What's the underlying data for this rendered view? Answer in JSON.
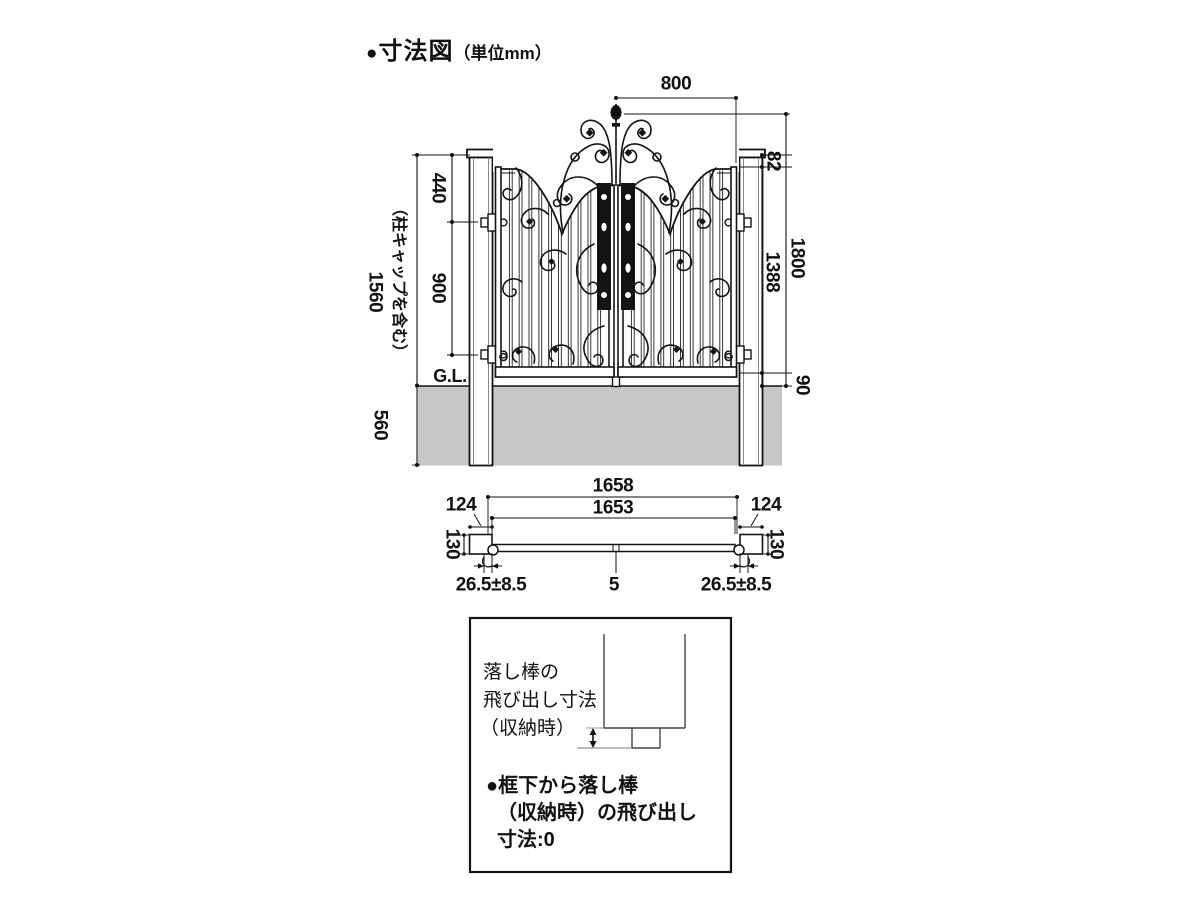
{
  "title": {
    "bullet": "●",
    "main": "寸法図",
    "unit": "（単位mm）"
  },
  "colors": {
    "line": "#1a1a1a",
    "ground_gray": "#c5c7c8",
    "plate_black": "#141414"
  },
  "elevation": {
    "dims": {
      "leaf_width": "800",
      "cap_to_rail": "82",
      "post_top_to_hinge": "440",
      "hinge_span": "900",
      "post_height": "1560",
      "post_height_note": "（柱キャップを含む）",
      "leaf_height": "1388",
      "gate_height": "1800",
      "ground_clearance": "90",
      "embed_depth": "560",
      "ground_line": "G.L."
    }
  },
  "plan": {
    "dims": {
      "overall_width": "1658",
      "inner_width": "1653",
      "post_width_left": "124",
      "post_width_right": "124",
      "post_depth_left": "130",
      "post_depth_right": "130",
      "hinge_offset_left": "26.5±8.5",
      "center_gap": "5",
      "hinge_offset_right": "26.5±8.5"
    }
  },
  "detail": {
    "label_lines": [
      "落し棒の",
      "飛び出し寸法",
      "（収納時）"
    ],
    "note_lines": [
      "●框下から落し棒",
      "（収納時）の飛び出し",
      "寸法:0"
    ]
  }
}
